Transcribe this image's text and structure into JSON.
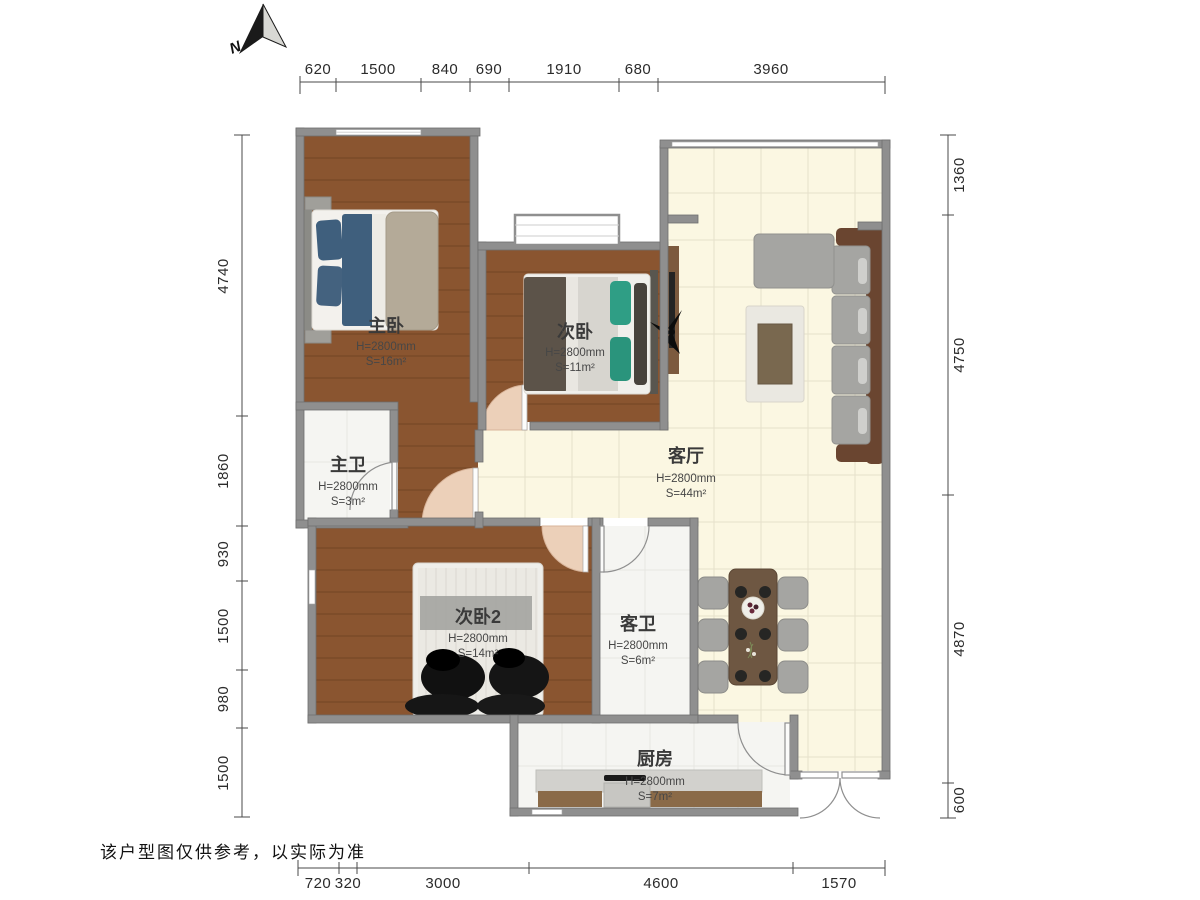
{
  "compass": {
    "label": "N"
  },
  "rooms": [
    {
      "id": "master-bedroom",
      "name": "主卧",
      "height": "H=2800mm",
      "area": "S=16m²"
    },
    {
      "id": "bedroom-2",
      "name": "次卧",
      "height": "H=2800mm",
      "area": "S=11m²"
    },
    {
      "id": "living-room",
      "name": "客厅",
      "height": "H=2800mm",
      "area": "S=44m²"
    },
    {
      "id": "master-bath",
      "name": "主卫",
      "height": "H=2800mm",
      "area": "S=3m²"
    },
    {
      "id": "bedroom-3",
      "name": "次卧2",
      "height": "H=2800mm",
      "area": "S=14m²"
    },
    {
      "id": "guest-bath",
      "name": "客卫",
      "height": "H=2800mm",
      "area": "S=6m²"
    },
    {
      "id": "kitchen",
      "name": "厨房",
      "height": "H=2800mm",
      "area": "S=7m²"
    }
  ],
  "dimensions": {
    "top": [
      "620",
      "1500",
      "840",
      "690",
      "1910",
      "680",
      "3960"
    ],
    "left": [
      "4740",
      "1860",
      "930",
      "1500",
      "980",
      "1500"
    ],
    "right": [
      "1360",
      "4750",
      "4870",
      "600"
    ],
    "bottom": [
      "720",
      "320",
      "3000",
      "4600",
      "1570"
    ]
  },
  "footer": {
    "disclaimer": "该户型图仅供参考，以实际为准"
  },
  "colors": {
    "wall": "#8f8f8f",
    "wood_floor": "#8a5530",
    "tile_floor": "#fbf7e2",
    "marble_floor": "#f5f5f2",
    "door_swing": "#ecd0b9",
    "sofa_frame": "#6a4530",
    "cushion_gray": "#a5a5a2",
    "teal_pillow": "#2f9e85",
    "blue_duvet": "#3f5f7d",
    "table_wood": "#6e5742"
  }
}
